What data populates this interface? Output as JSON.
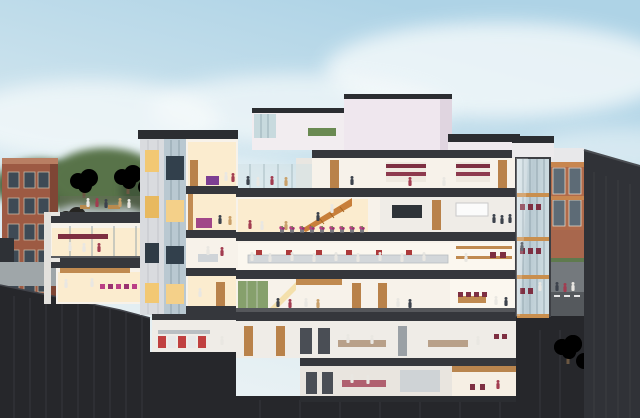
{
  "meta": {
    "alt": "Cutaway section rendering of a multi-storey building showing furnished, lit interiors with people on every level, an orange central staircase, magenta planters and chairs, labs with white-coated workers, a rooftop terrace with trees, a glass stair tower, neighbouring red-brick buildings, soft blue sky and a dark excavated base."
  },
  "colors": {
    "sky_top": "#aed3e6",
    "sky_mid": "#d8e9f0",
    "sky_bottom": "#eef4f5",
    "cloud": "#f6fafb",
    "slab": "#35373c",
    "slab_dark": "#2b2d31",
    "base": "#26272b",
    "side_wall": "#303237",
    "interior": "#f7f2ea",
    "warm_glow": "#fbeccf",
    "white_wall": "#efece7",
    "wood": "#c08a50",
    "stair_orange": "#c87f3a",
    "accent_magenta": "#bb3f85",
    "accent_maroon": "#7e2f42",
    "lab_red": "#ad3a3a",
    "brick_left": "#9d5a43",
    "brick_right": "#b06a4a",
    "foliage": "#5d7a4c",
    "foliage_dark": "#42593a",
    "glass": "#c5d4da",
    "panel": "#d9dbdf",
    "window_lit": "#f2c873",
    "window_dark": "#3e4a55",
    "pavement": "#9fa6a9"
  }
}
